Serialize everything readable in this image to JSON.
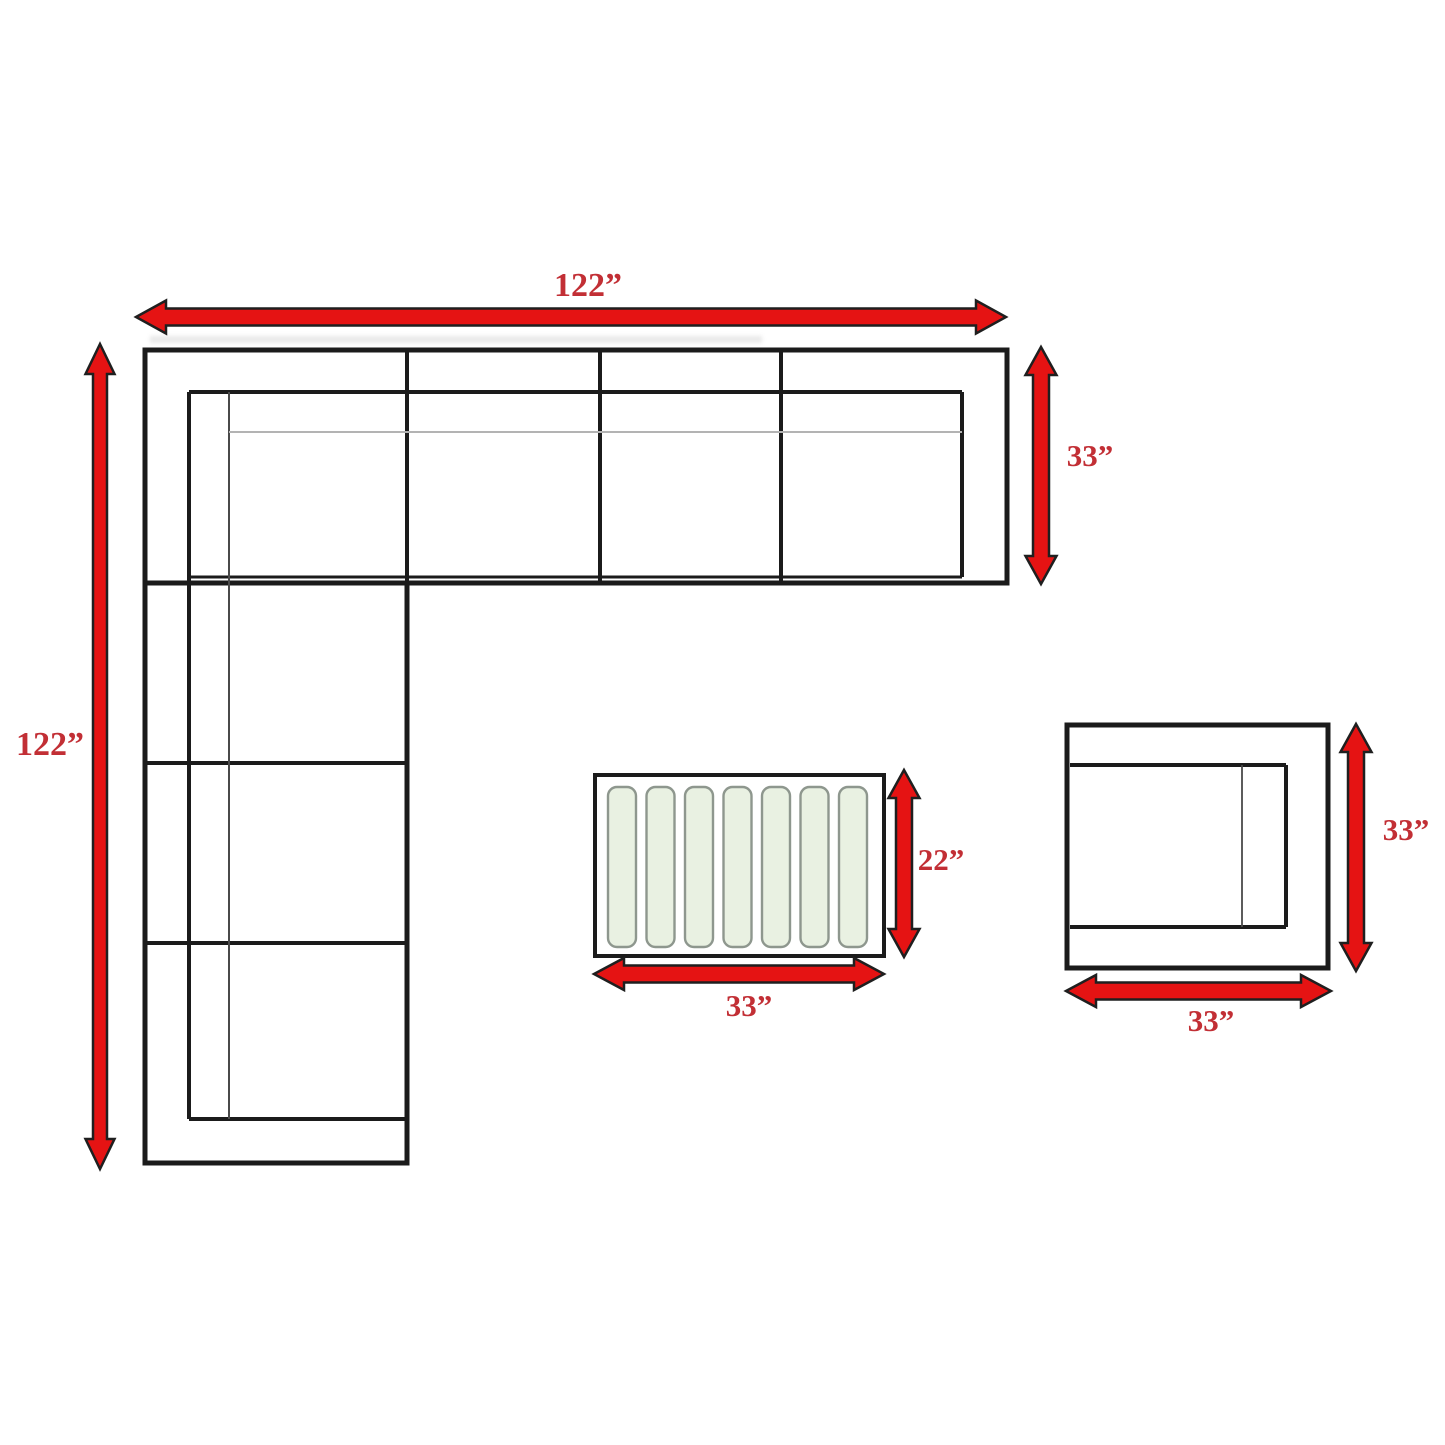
{
  "page": {
    "kind": "furniture-dimension-floorplan",
    "background": "#ffffff",
    "canvas": {
      "width": 1445,
      "height": 1445
    }
  },
  "colors": {
    "line": "#1b1b1b",
    "thin_line": "#4a4a4a",
    "seam_line": "#b3b3b3",
    "arrow_fill": "#e51313",
    "arrow_outline": "#1f1f1f",
    "label_color": "#c22f35",
    "slat_fill": "#e9f1e2",
    "slat_stroke": "#8e978e",
    "smudge": "#d6d6d6",
    "white": "#ffffff"
  },
  "dimensions": {
    "sofa_total_width": "122”",
    "sofa_total_depth": "122”",
    "sofa_section_depth": "33”",
    "table_depth": "22”",
    "table_width": "33”",
    "chair_depth": "33”",
    "chair_width": "33”"
  },
  "labels": [
    {
      "id": "label-sofa-width",
      "text": "122”",
      "x": 588,
      "y": 296,
      "size": 34
    },
    {
      "id": "label-sofa-height",
      "text": "122”",
      "x": 50,
      "y": 755,
      "size": 34
    },
    {
      "id": "label-sofa-depth",
      "text": "33”",
      "x": 1090,
      "y": 466,
      "size": 31
    },
    {
      "id": "label-table-depth",
      "text": "22”",
      "x": 941,
      "y": 870,
      "size": 31
    },
    {
      "id": "label-table-width",
      "text": "33”",
      "x": 749,
      "y": 1016,
      "size": 31
    },
    {
      "id": "label-chair-depth",
      "text": "33”",
      "x": 1406,
      "y": 840,
      "size": 31
    },
    {
      "id": "label-chair-width",
      "text": "33”",
      "x": 1211,
      "y": 1031,
      "size": 31
    }
  ],
  "arrows": [
    {
      "id": "arrow-sofa-width",
      "orient": "h",
      "x1": 136,
      "x2": 1006,
      "y": 317,
      "body": 17,
      "headW": 33,
      "headL": 30
    },
    {
      "id": "arrow-sofa-height",
      "orient": "v",
      "y1": 344,
      "y2": 1169,
      "x": 100,
      "body": 14,
      "headW": 29,
      "headL": 30
    },
    {
      "id": "arrow-sofa-depth",
      "orient": "v",
      "y1": 347,
      "y2": 584,
      "x": 1041,
      "body": 16,
      "headW": 31,
      "headL": 28
    },
    {
      "id": "arrow-table-depth",
      "orient": "v",
      "y1": 770,
      "y2": 957,
      "x": 904,
      "body": 16,
      "headW": 31,
      "headL": 28
    },
    {
      "id": "arrow-table-width",
      "orient": "h",
      "x1": 594,
      "x2": 884,
      "y": 974,
      "body": 17,
      "headW": 32,
      "headL": 30
    },
    {
      "id": "arrow-chair-depth",
      "orient": "v",
      "y1": 724,
      "y2": 971,
      "x": 1356,
      "body": 16,
      "headW": 31,
      "headL": 28
    },
    {
      "id": "arrow-chair-width",
      "orient": "h",
      "x1": 1066,
      "x2": 1331,
      "y": 991,
      "body": 17,
      "headW": 32,
      "headL": 30
    }
  ],
  "sofa": {
    "name": "sectional-sofa",
    "outline": {
      "d": "M145,350 H1007 V583 H407 V1163 H145 Z",
      "w": 5
    },
    "lines": [
      {
        "name": "front-edge-left-wing",
        "x1": 145,
        "y1": 583,
        "x2": 407,
        "y2": 583,
        "w": 5
      },
      {
        "name": "seat-divider-corner",
        "x1": 407,
        "y1": 350,
        "x2": 407,
        "y2": 583,
        "w": 4
      },
      {
        "name": "seat-divider-2",
        "x1": 600,
        "y1": 350,
        "x2": 600,
        "y2": 583,
        "w": 4
      },
      {
        "name": "seat-divider-3",
        "x1": 781,
        "y1": 350,
        "x2": 781,
        "y2": 583,
        "w": 4
      },
      {
        "name": "left-wing-divider-1",
        "x1": 145,
        "y1": 763,
        "x2": 407,
        "y2": 763,
        "w": 4
      },
      {
        "name": "left-wing-divider-2",
        "x1": 145,
        "y1": 943,
        "x2": 407,
        "y2": 943,
        "w": 4
      },
      {
        "name": "backrest-inner-top",
        "x1": 189,
        "y1": 392,
        "x2": 962,
        "y2": 392,
        "w": 4
      },
      {
        "name": "backrest-inner-right",
        "x1": 962,
        "y1": 392,
        "x2": 962,
        "y2": 577,
        "w": 4
      },
      {
        "name": "seat-front-inner",
        "x1": 189,
        "y1": 577,
        "x2": 962,
        "y2": 577,
        "w": 3
      },
      {
        "name": "armrest-inner-left",
        "x1": 189,
        "y1": 392,
        "x2": 189,
        "y2": 1119,
        "w": 4
      },
      {
        "name": "armrest-inner-bottom",
        "x1": 189,
        "y1": 1119,
        "x2": 407,
        "y2": 1119,
        "w": 4
      },
      {
        "name": "armrest-edge-line",
        "x1": 229,
        "y1": 392,
        "x2": 229,
        "y2": 1119,
        "w": 2,
        "stroke": "thin_line"
      },
      {
        "name": "cushion-seam-line",
        "x1": 229,
        "y1": 432,
        "x2": 962,
        "y2": 432,
        "w": 2,
        "stroke": "seam_line"
      }
    ]
  },
  "table": {
    "name": "coffee-table",
    "rect": {
      "x": 595,
      "y": 775,
      "wd": 289,
      "ht": 181,
      "w": 4
    },
    "slats": {
      "y": 787,
      "height": 160,
      "width": 28,
      "rx": 9,
      "xs": [
        608,
        646.5,
        685,
        723.5,
        762,
        800.5,
        839
      ]
    }
  },
  "chair": {
    "name": "accent-chair",
    "outer": {
      "x": 1067,
      "y": 725,
      "wd": 261,
      "ht": 243,
      "w": 5
    },
    "lines": [
      {
        "name": "chair-seat-top",
        "x1": 1070,
        "y1": 765,
        "x2": 1286,
        "y2": 765,
        "w": 4
      },
      {
        "name": "chair-seat-right",
        "x1": 1286,
        "y1": 765,
        "x2": 1286,
        "y2": 927,
        "w": 4
      },
      {
        "name": "chair-seat-bottom",
        "x1": 1070,
        "y1": 927,
        "x2": 1286,
        "y2": 927,
        "w": 4
      },
      {
        "name": "chair-armrest-line",
        "x1": 1242,
        "y1": 765,
        "x2": 1242,
        "y2": 927,
        "w": 1.8,
        "stroke": "thin_line"
      }
    ]
  },
  "smudge": {
    "x": 150,
    "y": 336,
    "wd": 612,
    "ht": 7
  }
}
